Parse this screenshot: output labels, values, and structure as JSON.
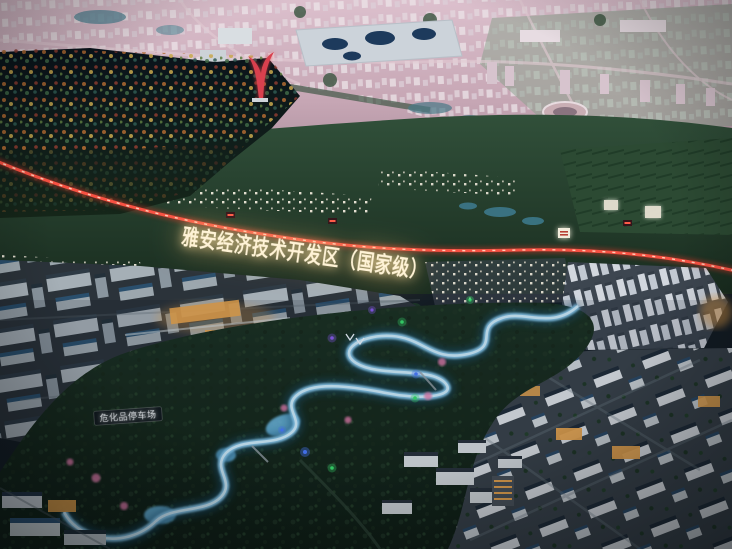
{
  "photo": {
    "title_overlay": "雅安经济技术开发区（国家级）",
    "signs": {
      "parking_sign": "危化品停车场"
    },
    "colors": {
      "title_glow": "#fff3d6",
      "railway_light_red": "#ff5344",
      "river_glow_blue": "#8fd0f4",
      "park_green": "#16281c",
      "distant_haze_pink": "#cdaebc",
      "building_light_amber": "#eaa64f",
      "led_green": "#3ae06e",
      "led_blue": "#4a7cff",
      "led_purple": "#8a5cf0",
      "blossom_pink": "#e87fb0"
    }
  }
}
